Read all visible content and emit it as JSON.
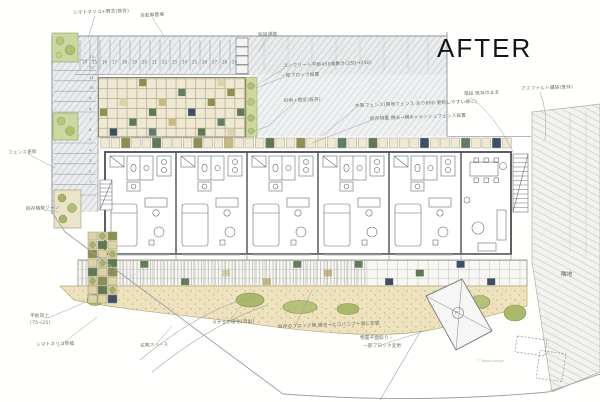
{
  "title": "AFTER",
  "copyright": "© Tanaka design",
  "pad_label": "P",
  "palette": {
    "beige": "#efe8d2",
    "khaki": "#ddd3a4",
    "tan": "#c9b97e",
    "olive": "#8d914f",
    "green": "#5d7a52",
    "teal": "#5f7d6a",
    "navy": "#3c4f68",
    "plant": "#a3b36a",
    "grass": "#cdd8a0",
    "gravel": "#eee2bf",
    "ink": "#4a4f55"
  },
  "annotations": [
    {
      "text": "シマトネリコ+野芝(既存)",
      "x": 73,
      "y": 10,
      "rot": -2
    },
    {
      "text": "自転車置場",
      "x": 140,
      "y": 13,
      "rot": -3
    },
    {
      "text": "仮設通路",
      "x": 258,
      "y": 32,
      "rot": -2
    },
    {
      "text": "コンクリート平板450角敷き(250→250)",
      "x": 283,
      "y": 63,
      "rot": -2
    },
    {
      "text": "一部ブロック設置",
      "x": 281,
      "y": 73,
      "rot": -2
    },
    {
      "text": "砂利+野芝(既存)",
      "x": 284,
      "y": 98,
      "rot": -2
    },
    {
      "text": "木製フェンス(隣地フェンス あり800 更新しやすい様に)",
      "x": 355,
      "y": 103,
      "rot": -2
    },
    {
      "text": "既存物置 撤去→横木+メッシュフェンス設置",
      "x": 370,
      "y": 116,
      "rot": -2
    },
    {
      "text": "階段 既存のまま",
      "x": 464,
      "y": 91,
      "rot": -2
    },
    {
      "text": "アスファルト舗装(既存)",
      "x": 521,
      "y": 86,
      "rot": -2
    },
    {
      "text": "フェンス更新",
      "x": 8,
      "y": 150,
      "rot": -2
    },
    {
      "text": "既存植栽ゾーン",
      "x": 26,
      "y": 206,
      "rot": -2
    },
    {
      "text": "平板同上",
      "x": 30,
      "y": 313,
      "rot": 0
    },
    {
      "text": "(75→25)",
      "x": 30,
      "y": 321,
      "rot": 0
    },
    {
      "text": "シマトネリコ移植",
      "x": 36,
      "y": 342,
      "rot": -2
    },
    {
      "text": "マサ土の硬化(流出)",
      "x": 212,
      "y": 320,
      "rot": -2
    },
    {
      "text": "既存のブロック塀 撤去→エコバンブー塀に変更",
      "x": 278,
      "y": 324,
      "rot": -2
    },
    {
      "text": "物置平面取り・",
      "x": 360,
      "y": 335,
      "rot": 0
    },
    {
      "text": "一部ブロック変更",
      "x": 363,
      "y": 343,
      "rot": 0
    },
    {
      "text": "玄関スペース",
      "x": 140,
      "y": 343,
      "rot": -3
    },
    {
      "text": "隣地",
      "x": 561,
      "y": 270,
      "rot": 0,
      "big": true
    }
  ],
  "parking": {
    "top_stalls": [
      "14",
      "15",
      "16",
      "17",
      "18",
      "19",
      "20",
      "21",
      "22",
      "23",
      "24",
      "25",
      "26",
      "27",
      "28",
      "29"
    ],
    "left_stalls": [
      "13",
      "12",
      "11",
      "10",
      "9",
      "8",
      "7",
      "6",
      "5",
      "4",
      "3",
      "2",
      "1"
    ]
  },
  "paving": {
    "courtyard": {
      "tiles": [
        {
          "c": 4,
          "r": 0,
          "k": "olive"
        },
        {
          "c": 12,
          "r": 0,
          "k": "khaki"
        },
        {
          "c": 8,
          "r": 1,
          "k": "teal"
        },
        {
          "c": 13,
          "r": 1,
          "k": "olive"
        },
        {
          "c": 2,
          "r": 2,
          "k": "khaki"
        },
        {
          "c": 6,
          "r": 2,
          "k": "tan"
        },
        {
          "c": 11,
          "r": 2,
          "k": "olive"
        },
        {
          "c": 0,
          "r": 3,
          "k": "olive"
        },
        {
          "c": 5,
          "r": 3,
          "k": "green"
        },
        {
          "c": 9,
          "r": 3,
          "k": "navy"
        },
        {
          "c": 14,
          "r": 3,
          "k": "green"
        },
        {
          "c": 3,
          "r": 4,
          "k": "green"
        },
        {
          "c": 7,
          "r": 4,
          "k": "tan"
        },
        {
          "c": 12,
          "r": 4,
          "k": "teal"
        },
        {
          "c": 1,
          "r": 5,
          "k": "navy"
        },
        {
          "c": 5,
          "r": 5,
          "k": "teal"
        },
        {
          "c": 10,
          "r": 5,
          "k": "green"
        },
        {
          "c": 13,
          "r": 5,
          "k": "khaki"
        }
      ]
    },
    "planter_row": {
      "cols": 40,
      "accent_tiles": [
        {
          "c": 2,
          "k": "olive"
        },
        {
          "c": 5,
          "k": "green"
        },
        {
          "c": 9,
          "k": "olive"
        },
        {
          "c": 12,
          "k": "tan"
        },
        {
          "c": 16,
          "k": "green"
        },
        {
          "c": 19,
          "k": "olive"
        },
        {
          "c": 23,
          "k": "teal"
        },
        {
          "c": 26,
          "k": "green"
        },
        {
          "c": 31,
          "k": "navy"
        },
        {
          "c": 35,
          "k": "teal"
        },
        {
          "c": 38,
          "k": "navy"
        }
      ]
    },
    "walkway": {
      "tiles": [
        {
          "c": 3,
          "r": 1,
          "k": "khaki"
        },
        {
          "c": 6,
          "r": 0,
          "k": "green"
        },
        {
          "c": 10,
          "r": 2,
          "k": "green"
        },
        {
          "c": 14,
          "r": 1,
          "k": "khaki"
        },
        {
          "c": 18,
          "r": 2,
          "k": "tan"
        },
        {
          "c": 21,
          "r": 0,
          "k": "green"
        },
        {
          "c": 24,
          "r": 1,
          "k": "tan"
        },
        {
          "c": 27,
          "r": 0,
          "k": "green"
        },
        {
          "c": 30,
          "r": 2,
          "k": "navy"
        },
        {
          "c": 33,
          "r": 1,
          "k": "green"
        },
        {
          "c": 37,
          "r": 0,
          "k": "navy"
        },
        {
          "c": 40,
          "r": 2,
          "k": "navy"
        }
      ]
    },
    "garden": {
      "rows": [
        [
          "khaki",
          "plant",
          "olive"
        ],
        [
          "plant",
          "green",
          "khaki"
        ],
        [
          "olive",
          "khaki",
          "plant"
        ],
        [
          "khaki",
          "plant",
          "green"
        ],
        [
          "green",
          "khaki",
          "olive"
        ],
        [
          "plant",
          "olive",
          "khaki"
        ],
        [
          "khaki",
          "green",
          "plant"
        ],
        [
          "khaki",
          "khaki",
          "navy"
        ]
      ]
    }
  }
}
